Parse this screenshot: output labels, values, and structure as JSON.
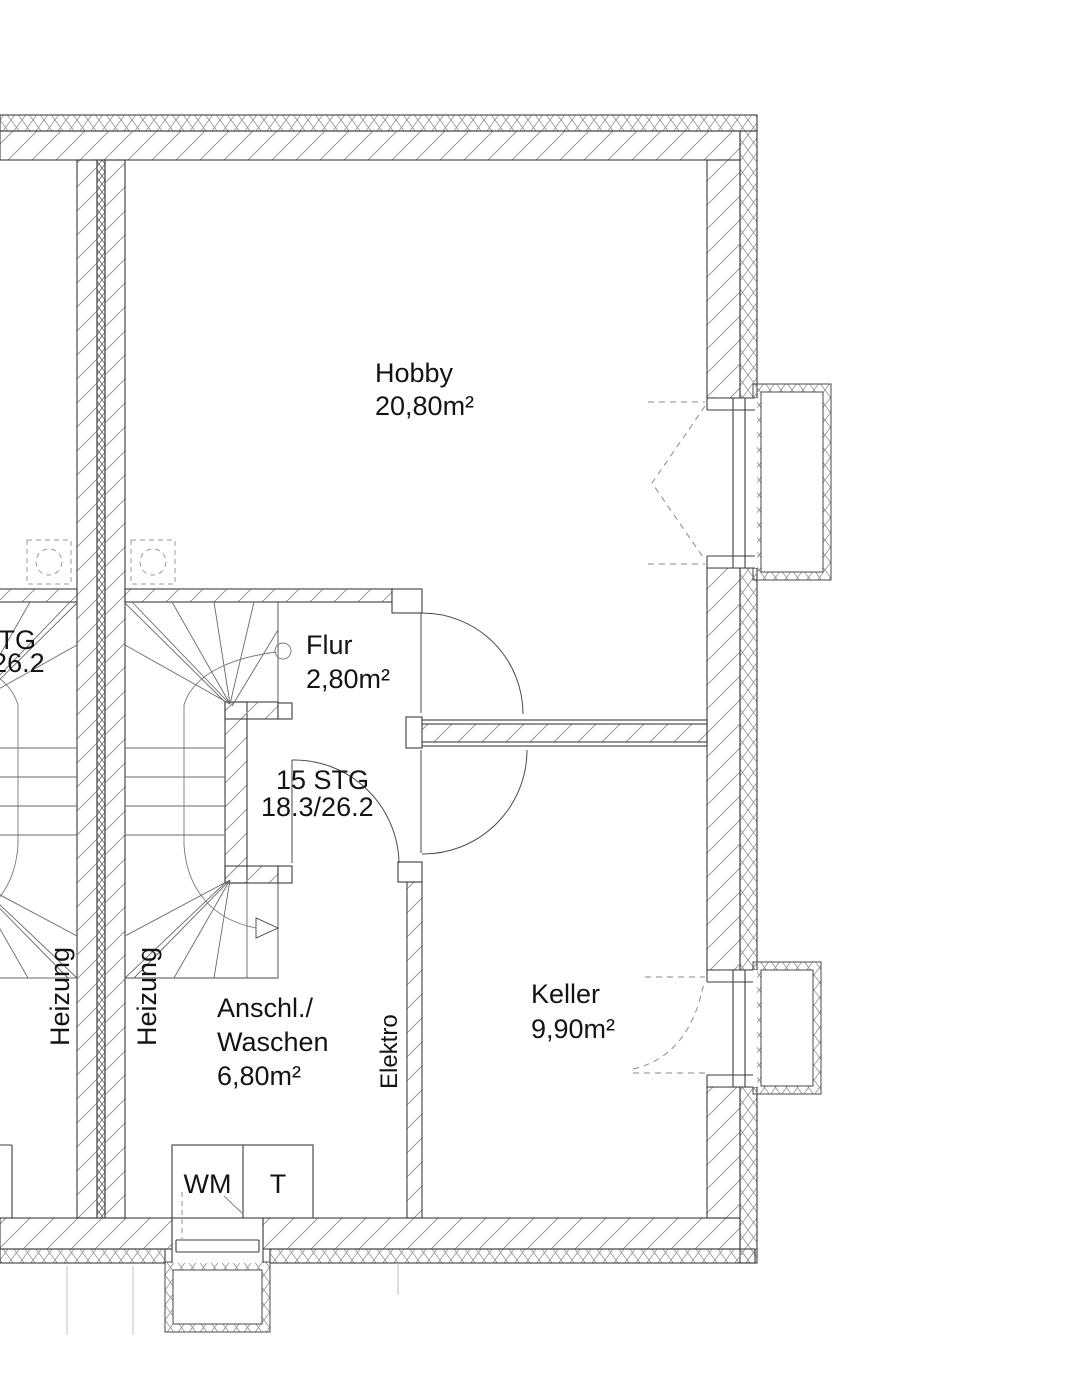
{
  "plan": {
    "type": "basement floor plan (Kellergeschoss), semi-detached house, right unit visible",
    "unit_right": {
      "rooms": {
        "hobby": {
          "name": "Hobby",
          "area": "20,80m²"
        },
        "flur": {
          "name": "Flur",
          "area": "2,80m²"
        },
        "keller": {
          "name": "Keller",
          "area": "9,90m²"
        },
        "anschluss_waschen": {
          "name_line1": "Anschl./",
          "name_line2": "Waschen",
          "area": "6,80m²"
        }
      },
      "labels": {
        "stair_steps": "15 STG",
        "stair_dimensions": "18.3/26.2",
        "elektro": "Elektro",
        "heizung": "Heizung",
        "washing_machine": "WM",
        "dryer": "T"
      }
    },
    "unit_left": {
      "labels": {
        "stair_steps": "15 STG",
        "stair_dimensions": "18.3/26.2",
        "heizung": "Heizung"
      }
    }
  }
}
